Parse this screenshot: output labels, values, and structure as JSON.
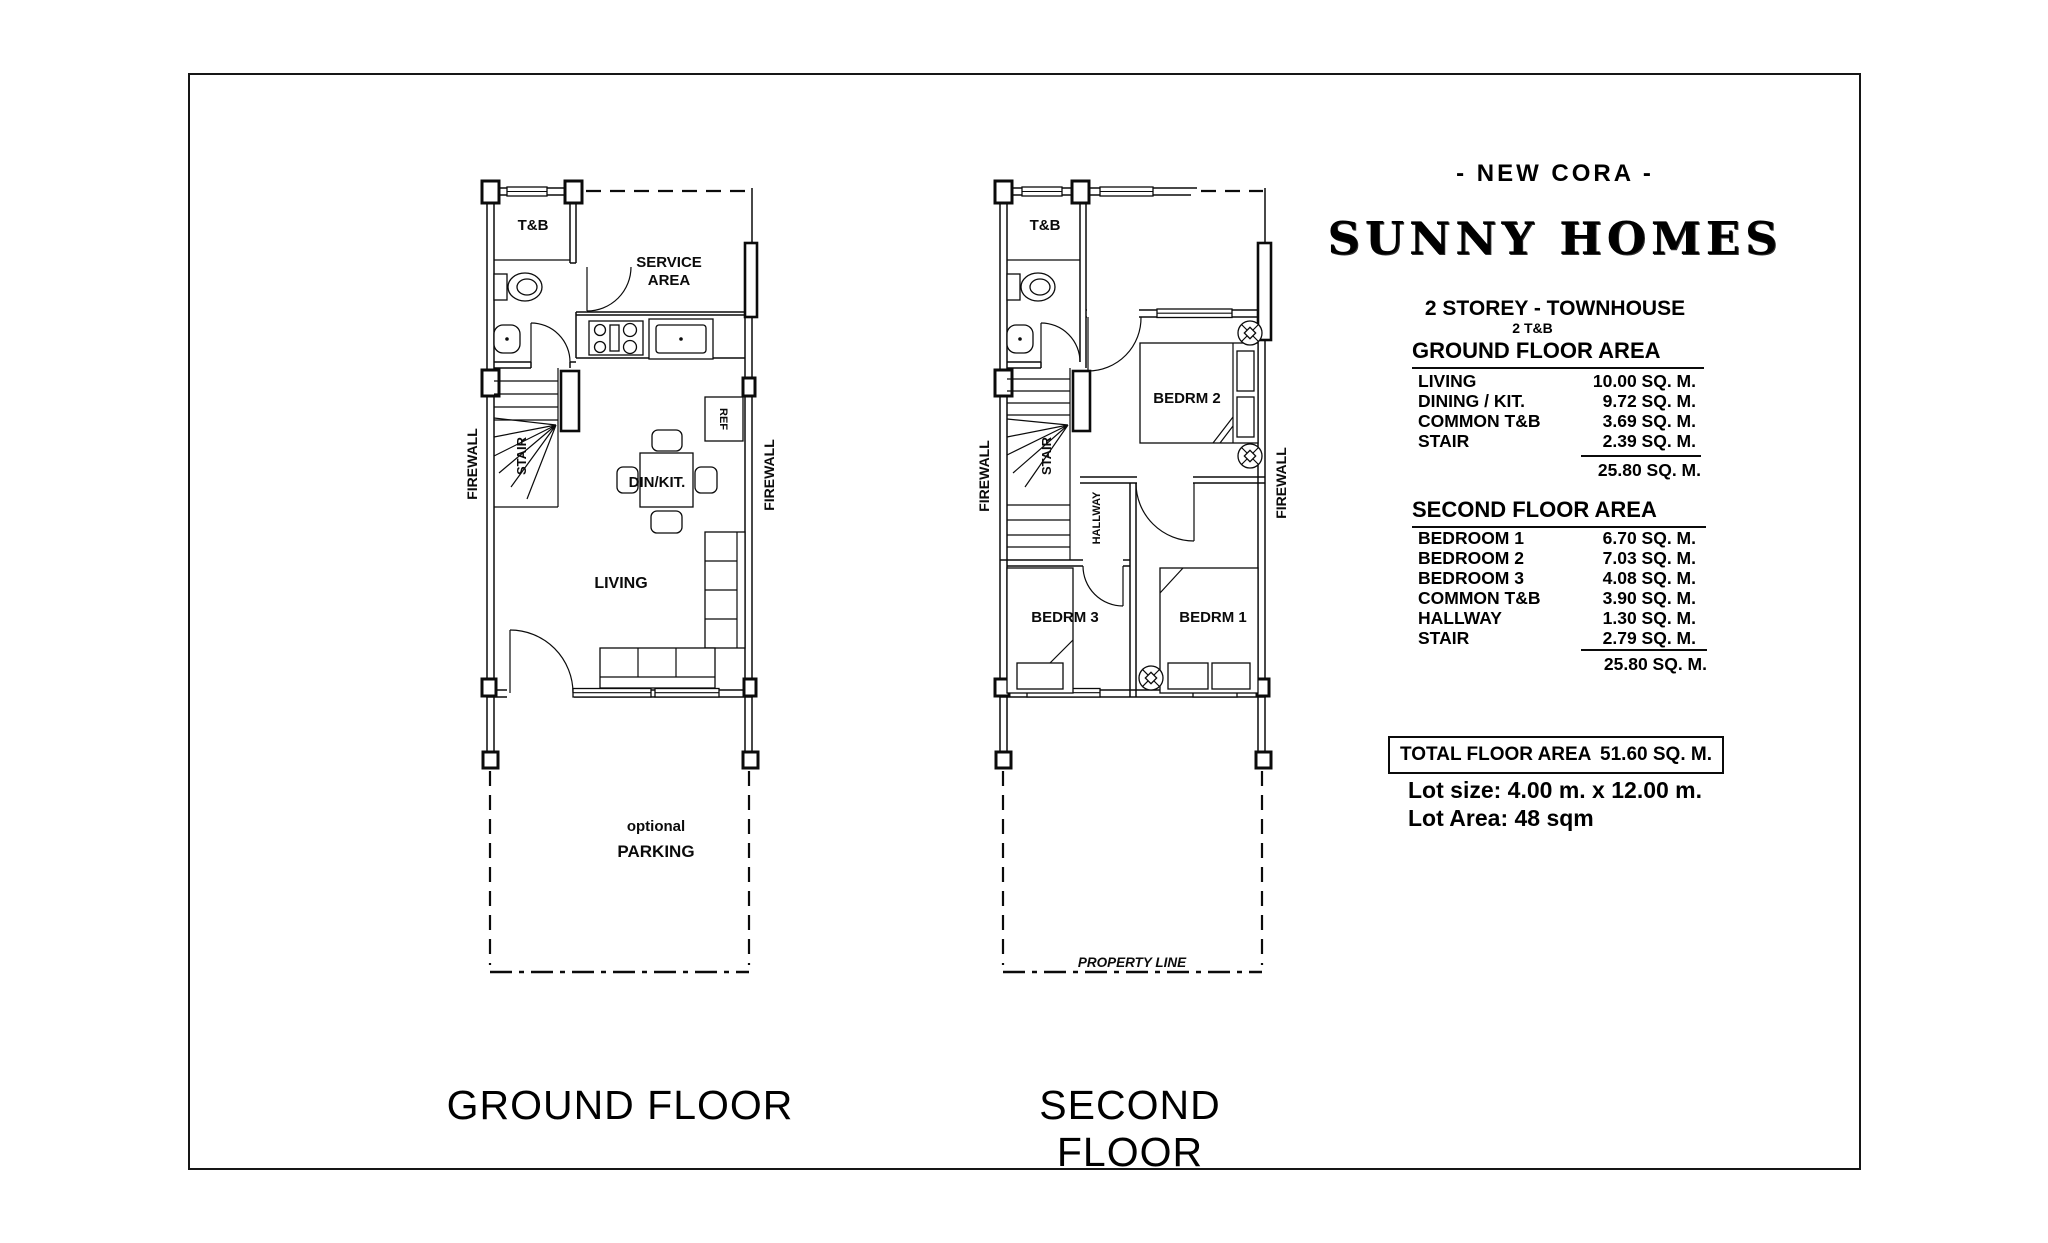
{
  "header": {
    "model": "- NEW CORA -",
    "brand": "SUNNY HOMES",
    "type": "2 STOREY - TOWNHOUSE",
    "baths": "2 T&B"
  },
  "ground_floor_area": {
    "title": "GROUND FLOOR AREA",
    "rows": [
      {
        "label": "LIVING",
        "value": "10.00 SQ. M."
      },
      {
        "label": "DINING / KIT.",
        "value": "9.72 SQ. M."
      },
      {
        "label": "COMMON T&B",
        "value": "3.69 SQ. M."
      },
      {
        "label": "STAIR",
        "value": "2.39 SQ. M."
      }
    ],
    "total": "25.80 SQ. M."
  },
  "second_floor_area": {
    "title": "SECOND FLOOR AREA",
    "rows": [
      {
        "label": "BEDROOM 1",
        "value": "6.70 SQ. M."
      },
      {
        "label": "BEDROOM 2",
        "value": "7.03 SQ. M."
      },
      {
        "label": "BEDROOM 3",
        "value": "4.08 SQ. M."
      },
      {
        "label": "COMMON T&B",
        "value": "3.90 SQ. M."
      },
      {
        "label": "HALLWAY",
        "value": "1.30 SQ. M."
      },
      {
        "label": "STAIR",
        "value": "2.79 SQ. M."
      }
    ],
    "total": "25.80 SQ. M."
  },
  "total_floor_area": {
    "label": "TOTAL FLOOR AREA",
    "value": "51.60 SQ. M."
  },
  "lot": {
    "size": "Lot size: 4.00 m. x 12.00 m.",
    "area": "Lot Area: 48 sqm"
  },
  "ground_plan": {
    "title": "GROUND FLOOR",
    "labels": {
      "tb": "T&B",
      "service1": "SERVICE",
      "service2": "AREA",
      "stair": "STAIR",
      "firewall_left": "FIREWALL",
      "firewall_right": "FIREWALL",
      "ref": "REF",
      "dinkit": "DIN/KIT.",
      "living": "LIVING",
      "parking1": "optional",
      "parking2": "PARKING"
    }
  },
  "second_plan": {
    "title": "SECOND FLOOR",
    "labels": {
      "tb": "T&B",
      "bedrm2": "BEDRM 2",
      "bedrm3": "BEDRM 3",
      "bedrm1": "BEDRM 1",
      "hallway": "HALLWAY",
      "stair": "STAIR",
      "firewall_left": "FIREWALL",
      "firewall_right": "FIREWALL",
      "property_line": "PROPERTY LINE"
    }
  }
}
